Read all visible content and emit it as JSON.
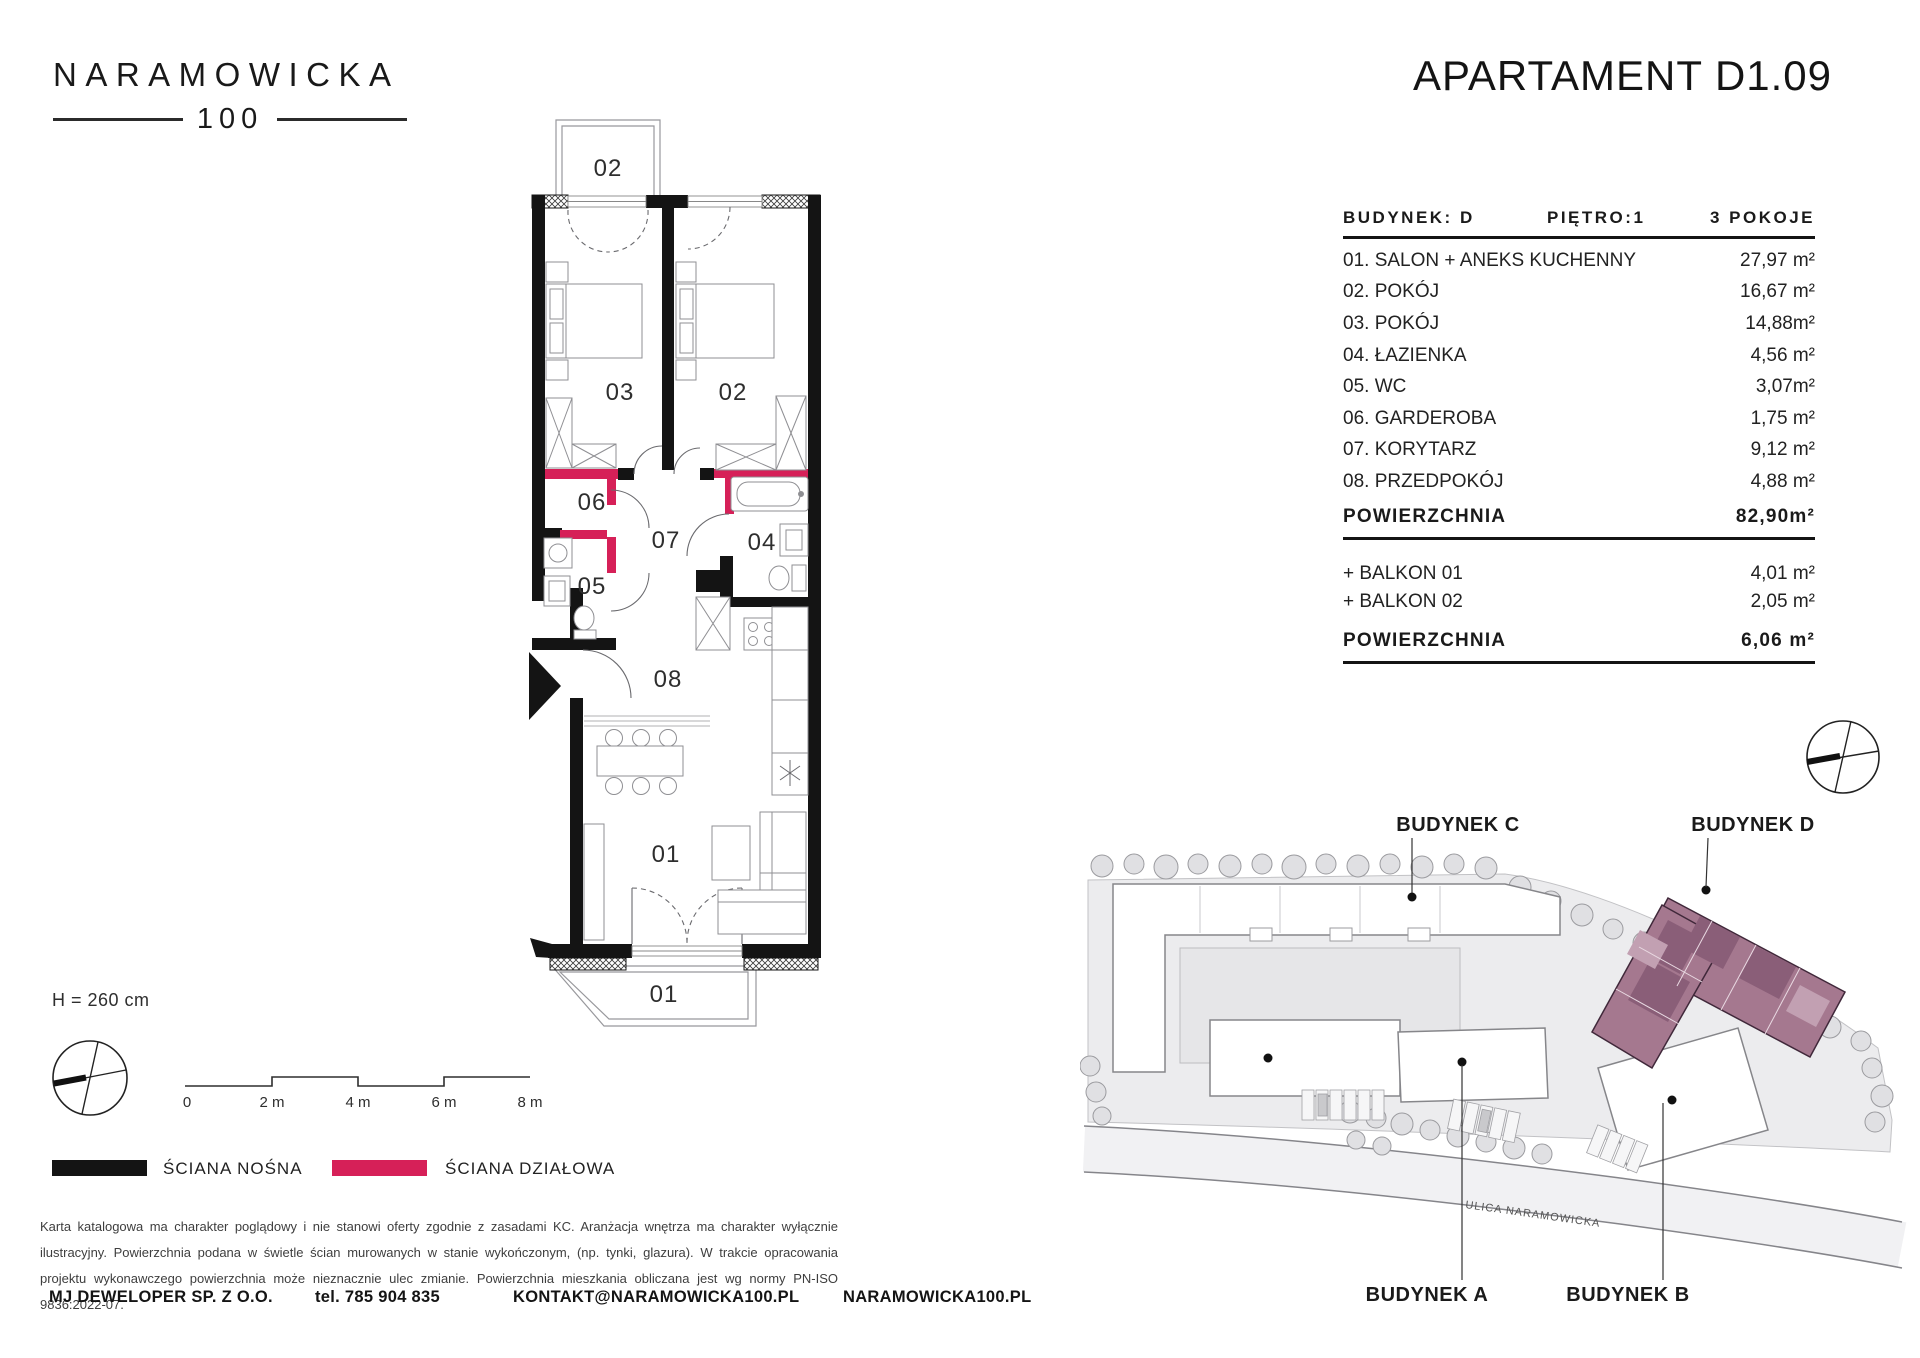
{
  "logo": {
    "name": "NARAMOWICKA",
    "number": "100"
  },
  "header": {
    "title": "APARTAMENT D1.09"
  },
  "spec": {
    "building": "BUDYNEK: D",
    "floor": "PIĘTRO:1",
    "rooms_count": "3 POKOJE",
    "rows": [
      {
        "no": "01.",
        "name": "SALON + ANEKS KUCHENNY",
        "area": "27,97 m²"
      },
      {
        "no": "02.",
        "name": "POKÓJ",
        "area": "16,67 m²"
      },
      {
        "no": "03.",
        "name": "POKÓJ",
        "area": "14,88m²"
      },
      {
        "no": "04.",
        "name": "ŁAZIENKA",
        "area": "4,56 m²"
      },
      {
        "no": "05.",
        "name": "WC",
        "area": "3,07m²"
      },
      {
        "no": "06.",
        "name": "GARDEROBA",
        "area": "1,75 m²"
      },
      {
        "no": "07.",
        "name": "KORYTARZ",
        "area": "9,12 m²"
      },
      {
        "no": "08.",
        "name": "PRZEDPOKÓJ",
        "area": "4,88 m²"
      }
    ],
    "total_label": "POWIERZCHNIA",
    "total_value": "82,90m²",
    "balconies": [
      {
        "label": "+ BALKON 01",
        "value": "4,01 m²"
      },
      {
        "label": "+ BALKON 02",
        "value": "2,05 m²"
      }
    ],
    "balcony_total_label": "POWIERZCHNIA",
    "balcony_total_value": "6,06 m²"
  },
  "plan": {
    "height_note": "H = 260 cm",
    "labels": {
      "balcony_top": "02",
      "room03": "03",
      "room02": "02",
      "room06": "06",
      "room07": "07",
      "room05": "05",
      "room04": "04",
      "room08": "08",
      "room01": "01",
      "balcony_bottom": "01"
    },
    "scale": {
      "ticks": [
        "0",
        "2 m",
        "4 m",
        "6 m",
        "8 m"
      ]
    }
  },
  "legend": {
    "load_bearing": {
      "label": "ŚCIANA NOŚNA",
      "color": "#141414"
    },
    "partition": {
      "label": "ŚCIANA DZIAŁOWA",
      "color": "#d62058"
    }
  },
  "disclaimer": "Karta katalogowa ma charakter poglądowy i nie stanowi oferty zgodnie z zasadami KC. Aranżacja wnętrza ma charakter wyłącznie ilustracyjny. Powierzchnia podana w świetle ścian murowanych w stanie wykończonym, (np. tynki, glazura). W trakcie opracowania projektu wykonawczego powierzchnia może nieznacznie ulec zmianie. Powierzchnia mieszkania obliczana jest wg normy PN-ISO 9836:2022-07.",
  "footer": {
    "company": "MJ DEWELOPER SP. Z O.O.",
    "phone": "tel. 785 904 835",
    "email": "KONTAKT@NARAMOWICKA100.PL",
    "website": "NARAMOWICKA100.PL"
  },
  "sitemap": {
    "street": "ULICA NARAMOWICKA",
    "buildings": {
      "a": "BUDYNEK A",
      "b": "BUDYNEK B",
      "c": "BUDYNEK C",
      "d": "BUDYNEK D"
    }
  }
}
